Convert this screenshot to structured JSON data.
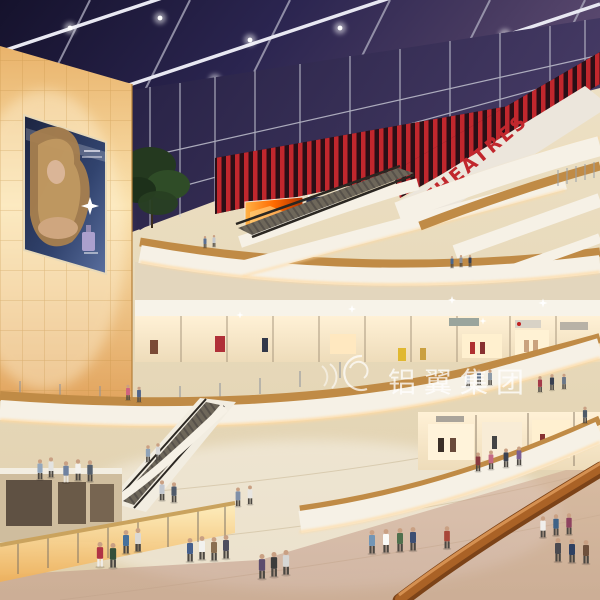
{
  "image": {
    "kind": "architectural rendering",
    "subject": "multi-level shopping mall atrium with skylight, theatre level, escalators and crowds"
  },
  "signs": {
    "theatres": "THEATRES",
    "watermark": "铝翼集团"
  },
  "palette": {
    "ceiling_night": "#15122c",
    "ceiling_violet": "#5e4c72",
    "beam": "#e8e8f2",
    "sign_red": "#c1272d",
    "fascia_white": "#f6f1e6",
    "cove_glow": "#ffd9a0",
    "wood_balustrade": "#c08b46",
    "handrail_wood": "#aa6226",
    "amber_wall": "#f3c67c",
    "floor_beige": "#e7d9bc",
    "billboard_navy": "#232e52",
    "screen_fire": "#ff7d1f"
  },
  "figures": [
    {
      "x": 205,
      "y": 247,
      "s": 0.5,
      "c": "#5a6f93"
    },
    {
      "x": 214,
      "y": 246,
      "s": 0.5,
      "c": "#c2c6cc"
    },
    {
      "x": 452,
      "y": 267,
      "s": 0.5,
      "c": "#49668c"
    },
    {
      "x": 461,
      "y": 266,
      "s": 0.5,
      "c": "#8a8f98"
    },
    {
      "x": 470,
      "y": 266,
      "s": 0.5,
      "c": "#323f58"
    },
    {
      "x": 128,
      "y": 399,
      "s": 0.65,
      "c": "#cf6280"
    },
    {
      "x": 139,
      "y": 401,
      "s": 0.65,
      "c": "#50648a"
    },
    {
      "x": 540,
      "y": 391,
      "s": 0.68,
      "c": "#a43a49"
    },
    {
      "x": 552,
      "y": 389,
      "s": 0.68,
      "c": "#394050"
    },
    {
      "x": 564,
      "y": 388,
      "s": 0.65,
      "c": "#6b7788"
    },
    {
      "x": 468,
      "y": 386,
      "s": 0.66,
      "c": "#cfd3d8"
    },
    {
      "x": 479,
      "y": 384,
      "s": 0.66,
      "c": "#5d6f88"
    },
    {
      "x": 490,
      "y": 384,
      "s": 0.66,
      "c": "#8d9aa8"
    },
    {
      "x": 585,
      "y": 422,
      "s": 0.7,
      "c": "#4e5a68"
    },
    {
      "x": 40,
      "y": 478,
      "s": 0.85,
      "c": "#93a7bd"
    },
    {
      "x": 51,
      "y": 476,
      "s": 0.85,
      "c": "#e3e3e1"
    },
    {
      "x": 66,
      "y": 481,
      "s": 0.9,
      "c": "#6f82a0",
      "l": "#e8e4dc"
    },
    {
      "x": 78,
      "y": 479,
      "s": 0.9,
      "c": "#f4f2ee"
    },
    {
      "x": 90,
      "y": 480,
      "s": 0.9,
      "c": "#55606e"
    },
    {
      "x": 148,
      "y": 461,
      "s": 0.72,
      "c": "#8fa3b8"
    },
    {
      "x": 158,
      "y": 459,
      "s": 0.72,
      "c": "#d8d8d8"
    },
    {
      "x": 162,
      "y": 499,
      "s": 0.85,
      "c": "#c2c7cf"
    },
    {
      "x": 174,
      "y": 501,
      "s": 0.85,
      "c": "#4f5a6a"
    },
    {
      "x": 238,
      "y": 505,
      "s": 0.8,
      "c": "#8090a8"
    },
    {
      "x": 250,
      "y": 503,
      "s": 0.8,
      "c": "#e8e6e2"
    },
    {
      "x": 478,
      "y": 470,
      "s": 0.8,
      "c": "#8a3a3f"
    },
    {
      "x": 491,
      "y": 468,
      "s": 0.8,
      "c": "#c46a85"
    },
    {
      "x": 506,
      "y": 466,
      "s": 0.8,
      "c": "#3c4250"
    },
    {
      "x": 519,
      "y": 464,
      "s": 0.8,
      "c": "#7a5f93"
    },
    {
      "x": 100,
      "y": 565,
      "s": 1.05,
      "c": "#b03345",
      "l": "#f0ede8"
    },
    {
      "x": 113,
      "y": 566,
      "s": 1.05,
      "c": "#34503a"
    },
    {
      "x": 126,
      "y": 552,
      "s": 1,
      "c": "#46719c"
    },
    {
      "x": 138,
      "y": 550,
      "s": 1,
      "c": "#dcd9d4"
    },
    {
      "x": 190,
      "y": 560,
      "s": 1,
      "c": "#46608c"
    },
    {
      "x": 202,
      "y": 558,
      "s": 1,
      "c": "#f2f2ef"
    },
    {
      "x": 214,
      "y": 559,
      "s": 1,
      "c": "#8a6f52"
    },
    {
      "x": 226,
      "y": 557,
      "s": 1,
      "c": "#4e4e5e"
    },
    {
      "x": 262,
      "y": 577,
      "s": 1.05,
      "c": "#5c4c6e"
    },
    {
      "x": 274,
      "y": 575,
      "s": 1.05,
      "c": "#3c3c3c"
    },
    {
      "x": 286,
      "y": 573,
      "s": 1.05,
      "c": "#d6d6d4"
    },
    {
      "x": 372,
      "y": 552,
      "s": 1,
      "c": "#7295b5"
    },
    {
      "x": 386,
      "y": 551,
      "s": 1,
      "c": "#fafaf7"
    },
    {
      "x": 400,
      "y": 550,
      "s": 1,
      "c": "#50704e"
    },
    {
      "x": 413,
      "y": 549,
      "s": 1,
      "c": "#3d4f73"
    },
    {
      "x": 447,
      "y": 547,
      "s": 0.95,
      "c": "#a8473a"
    },
    {
      "x": 543,
      "y": 536,
      "s": 0.9,
      "c": "#f0efec"
    },
    {
      "x": 556,
      "y": 534,
      "s": 0.9,
      "c": "#3f6287"
    },
    {
      "x": 569,
      "y": 533,
      "s": 0.9,
      "c": "#8e4260"
    },
    {
      "x": 558,
      "y": 560,
      "s": 1,
      "c": "#4a4a50"
    },
    {
      "x": 572,
      "y": 561,
      "s": 1,
      "c": "#2e4062"
    },
    {
      "x": 586,
      "y": 562,
      "s": 1,
      "c": "#6e503c"
    }
  ]
}
